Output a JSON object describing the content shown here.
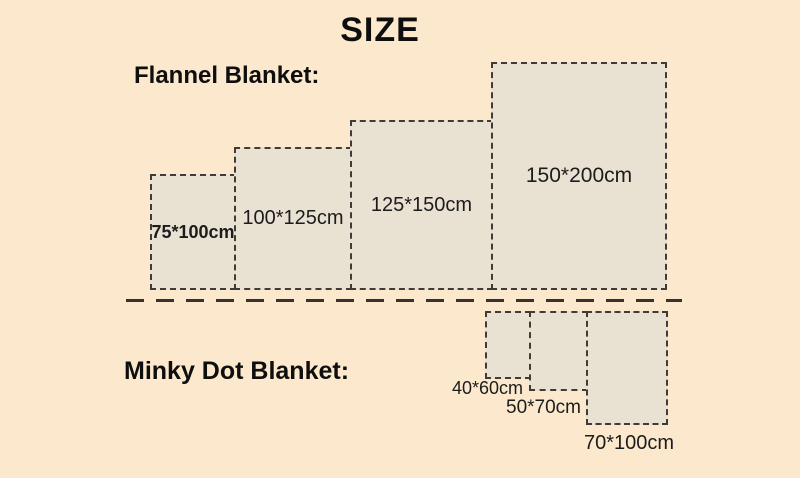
{
  "title": "SIZE",
  "flannel": {
    "label": "Flannel Blanket:",
    "items": [
      {
        "size": "75*100cm"
      },
      {
        "size": "100*125cm"
      },
      {
        "size": "125*150cm"
      },
      {
        "size": "150*200cm"
      }
    ]
  },
  "minky": {
    "label": "Minky Dot Blanket:",
    "items": [
      {
        "size": "40*60cm"
      },
      {
        "size": "50*70cm"
      },
      {
        "size": "70*100cm"
      }
    ]
  },
  "colors": {
    "background": "#fce9cd",
    "swatch_fill": "#e9e2d3",
    "dashed_border": "#3f3b35",
    "text": "#141414"
  }
}
